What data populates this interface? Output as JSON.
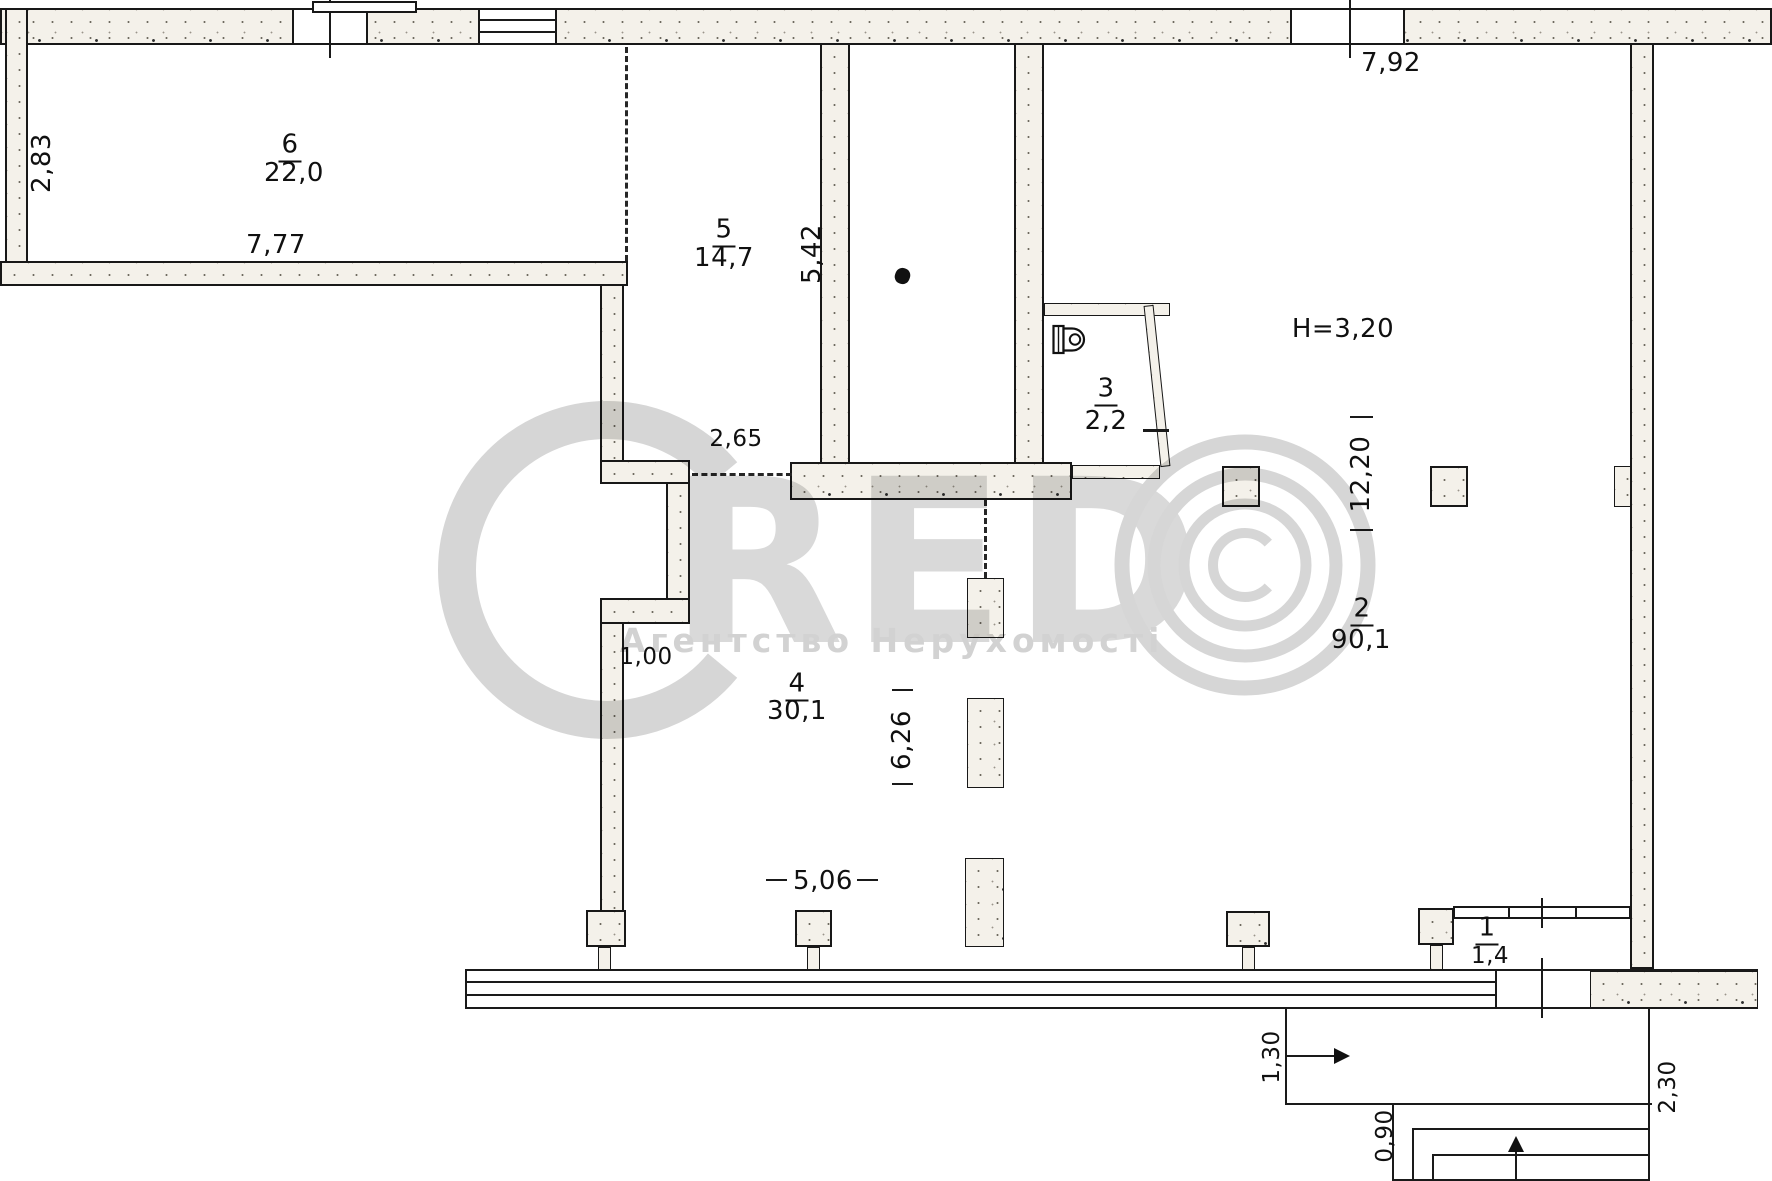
{
  "watermark": {
    "brand_c": "C",
    "brand_red": "RED",
    "brand_o": "©",
    "agency": "Агентство Нерухомості"
  },
  "note": {
    "ceiling_height": "H=3,20"
  },
  "rooms": [
    {
      "number": "6",
      "area": "22,0"
    },
    {
      "number": "5",
      "area": "14,7"
    },
    {
      "number": "3",
      "area": "2,2"
    },
    {
      "number": "2",
      "area": "90,1"
    },
    {
      "number": "4",
      "area": "30,1"
    },
    {
      "number": "1",
      "area": "1,4"
    }
  ],
  "dims": {
    "d283": "2,83",
    "d777": "7,77",
    "d542": "5,42",
    "d265": "2,65",
    "d792": "7,92",
    "d1220": "12,20",
    "d100": "1,00",
    "d626": "6,26",
    "d506": "5,06",
    "d130": "1,30",
    "d090": "0,90",
    "d230": "2,30"
  }
}
